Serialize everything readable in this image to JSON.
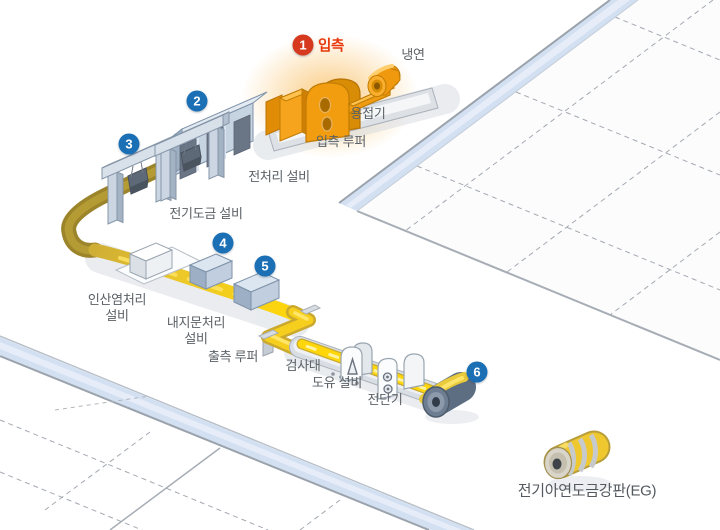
{
  "steps": [
    {
      "num": "1",
      "label": "입측"
    },
    {
      "num": "2"
    },
    {
      "num": "3"
    },
    {
      "num": "4"
    },
    {
      "num": "5"
    },
    {
      "num": "6"
    }
  ],
  "labels": {
    "cold_rolled": "냉연",
    "welder": "용접기",
    "entry_looper": "입측 루퍼",
    "pretreatment": "전처리 설비",
    "electroplating": "전기도금 설비",
    "phosphate": {
      "line1": "인산염처리",
      "line2": "설비"
    },
    "anti_fingerprint": {
      "line1": "내지문처리",
      "line2": "설비"
    },
    "exit_looper": "출측 루퍼",
    "inspection": "검사대",
    "oiling": "도유 설비",
    "shear": "전단기",
    "product": "전기아연도금강판(EG)"
  },
  "colors": {
    "badge_blue": "#1a6fb5",
    "badge_red": "#d6391e",
    "highlight_red": "#e8380d",
    "label_text": "#5b6166",
    "machine_orange": "#f29c10",
    "equipment_blue": "#c6d3e2",
    "strip_yellow": "#ffd60a",
    "strip_olive": "#9c842b",
    "road_blue": "#d3e0f2"
  }
}
